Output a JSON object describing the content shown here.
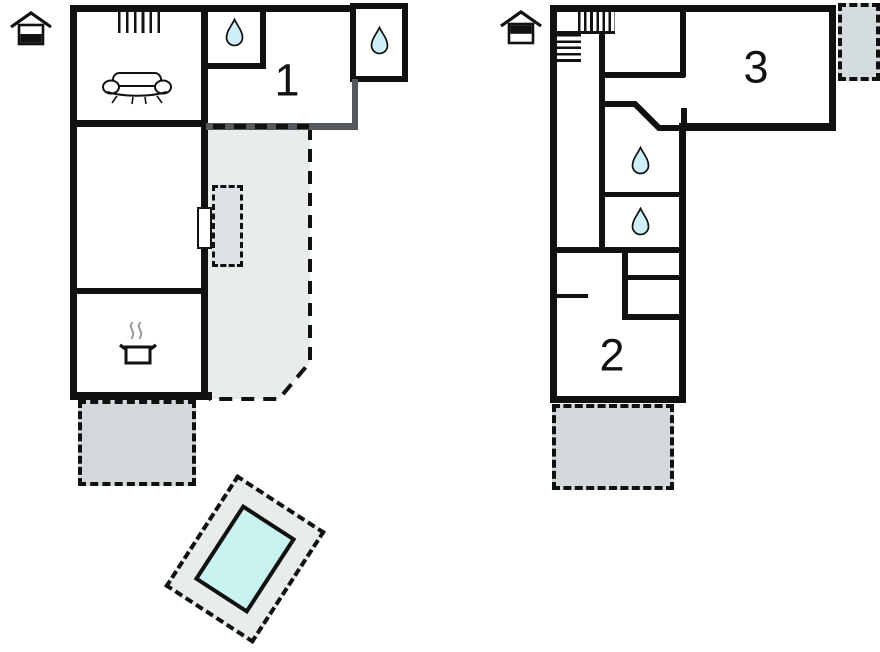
{
  "canvas": {
    "width": 880,
    "height": 652,
    "background": "#ffffff"
  },
  "colors": {
    "wall": "#111111",
    "wall_gray": "#56595b",
    "terrace_fill": "#d3d9db",
    "veranda_fill": "#e8eced",
    "entry_patch_fill": "#dee4e6",
    "balcony_fill": "#d5dcde",
    "pool_deck": "#e8ecec",
    "pool_water": "#c9f3f0",
    "water_drop_fill": "#cfeff8",
    "steam_gray": "#9aa0a2"
  },
  "ground_floor": {
    "floor_indicator_icon": "house-lower-level-icon",
    "room_label": "1",
    "icons": [
      "stairs-icon",
      "sofa-icon",
      "water-drop-icon",
      "water-drop-icon",
      "cooking-pot-icon"
    ],
    "outdoor_areas": [
      "covered-veranda",
      "terrace",
      "pool"
    ]
  },
  "upper_floor": {
    "floor_indicator_icon": "house-upper-level-icon",
    "room_labels": {
      "room3": "3",
      "room2": "2"
    },
    "icons": [
      "stairs-icon",
      "water-drop-icon",
      "water-drop-icon"
    ],
    "outdoor_areas": [
      "balcony",
      "terrace"
    ]
  }
}
